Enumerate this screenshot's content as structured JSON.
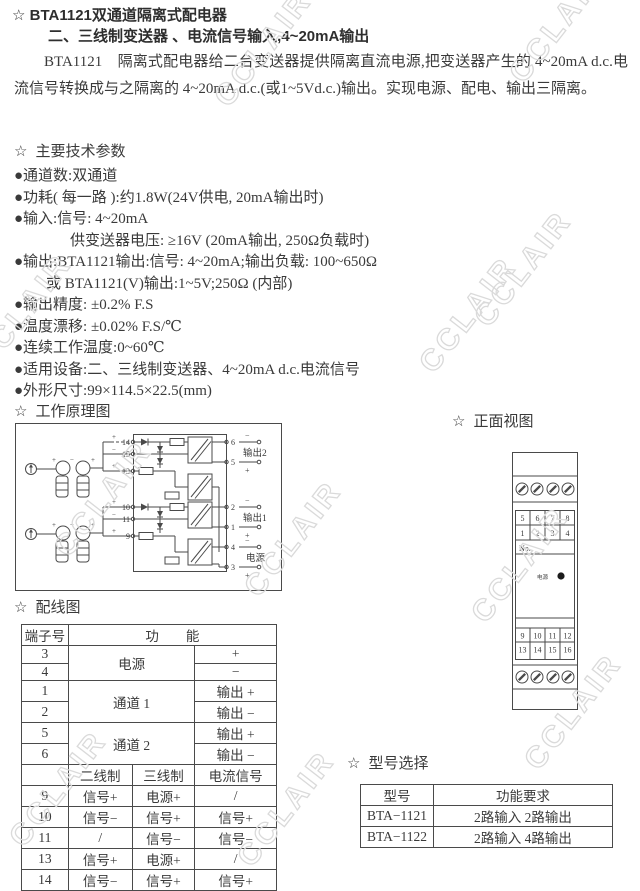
{
  "star": "☆",
  "watermark": {
    "text": "CCLAIR",
    "color": "#dadada"
  },
  "doc": {
    "title": "BTA1121双通道隔离式配电器",
    "subtitle": "二、三线制变送器 、电流信号输入,4~20mA输出",
    "intro": "BTA1121　隔离式配电器给二台变送器提供隔离直流电源,把变送器产生的 4~20mA d.c.电流信号转换成与之隔离的 4~20mA d.c.(或1~5Vd.c.)输出。实现电源、配电、输出三隔离。"
  },
  "specs": {
    "heading": "主要技术参数",
    "items": [
      "●通道数:双通道",
      "●功耗( 每一路 ):约1.8W(24V供电, 20mA输出时)",
      "●输入:信号: 4~20mA",
      "供变送器电压: ≥16V (20mA输出, 250Ω负载时)",
      "●输出:BTA1121输出:信号: 4~20mA;输出负载: 100~650Ω",
      "或 BTA1121(V)输出:1~5V;250Ω (内部)",
      "●输出精度: ±0.2% F.S",
      "●温度漂移: ±0.02% F.S/℃",
      "●连续工作温度:0~60℃",
      "●适用设备:二、三线制变送器、4~20mA d.c.电流信号",
      "●外形尺寸:99×114.5×22.5(mm)"
    ]
  },
  "principle": {
    "heading": "工作原理图",
    "out2": "输出2",
    "out1": "输出1",
    "power": "电源",
    "terminals_left_ch2": [
      "14",
      "15",
      "13"
    ],
    "terminals_left_ch1": [
      "10",
      "11",
      "9"
    ],
    "terminals_right": [
      "6",
      "5",
      "2",
      "1",
      "4",
      "3"
    ],
    "plus": "+",
    "minus": "−"
  },
  "front_view": {
    "heading": "正面视图",
    "top_numbers": [
      [
        "5",
        "6",
        "7",
        "8"
      ],
      [
        "1",
        "2",
        "3",
        "4"
      ]
    ],
    "no_label": "No.",
    "power_label": "电源",
    "bottom_numbers": [
      [
        "9",
        "10",
        "11",
        "12"
      ],
      [
        "13",
        "14",
        "15",
        "16"
      ]
    ]
  },
  "wiring": {
    "heading": "配线图",
    "header_terminal": "端子号",
    "header_function": "功　　能",
    "groups": [
      {
        "t": [
          "3",
          "4"
        ],
        "label": "电源",
        "vals": [
          "+",
          "−"
        ]
      },
      {
        "t": [
          "1",
          "2"
        ],
        "label": "通道 1",
        "vals": [
          "输出 +",
          "输出 −"
        ]
      },
      {
        "t": [
          "5",
          "6"
        ],
        "label": "通道 2",
        "vals": [
          "输出 +",
          "输出 −"
        ]
      }
    ],
    "subheader": [
      "二线制",
      "三线制",
      "电流信号"
    ],
    "rows": [
      [
        "9",
        "信号+",
        "电源+",
        "/"
      ],
      [
        "10",
        "信号−",
        "信号+",
        "信号+"
      ],
      [
        "11",
        "/",
        "信号−",
        "信号−"
      ],
      [
        "13",
        "信号+",
        "电源+",
        "/"
      ],
      [
        "14",
        "信号−",
        "信号+",
        "信号+"
      ],
      [
        "15",
        "/",
        "信号−",
        "信号−"
      ]
    ]
  },
  "models": {
    "heading": "型号选择",
    "headers": [
      "型号",
      "功能要求"
    ],
    "rows": [
      [
        "BTA−1121",
        "2路输入 2路输出"
      ],
      [
        "BTA−1122",
        "2路输入 4路输出"
      ]
    ]
  }
}
